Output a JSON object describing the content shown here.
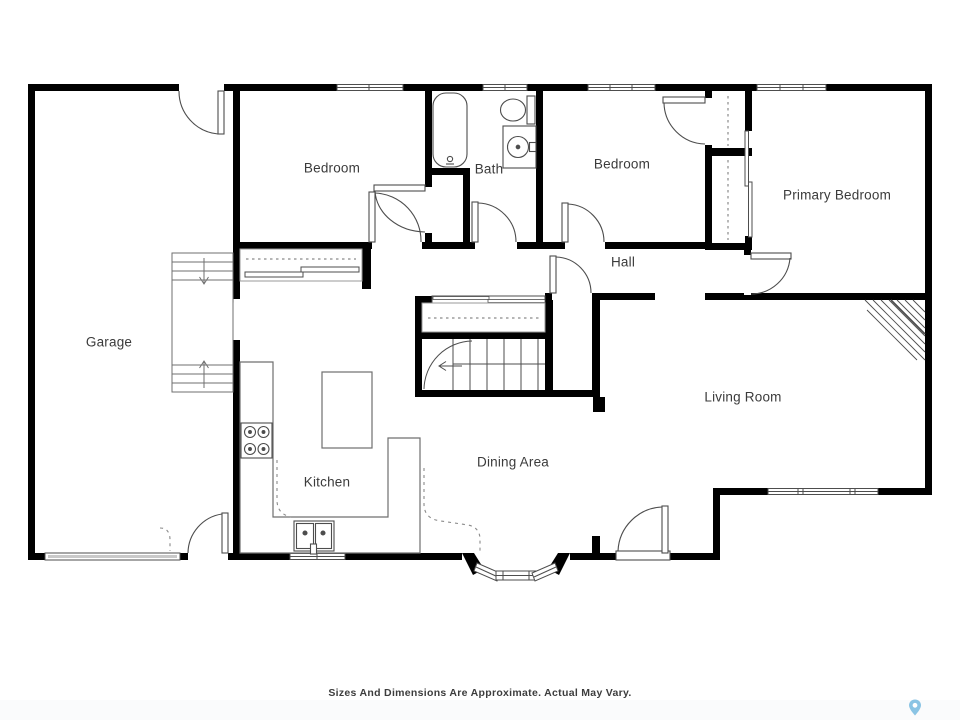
{
  "plan": {
    "rooms": [
      {
        "id": "garage",
        "label": "Garage"
      },
      {
        "id": "bedroom-1",
        "label": "Bedroom"
      },
      {
        "id": "bath",
        "label": "Bath"
      },
      {
        "id": "bedroom-2",
        "label": "Bedroom"
      },
      {
        "id": "primary-bedroom",
        "label": "Primary Bedroom"
      },
      {
        "id": "hall",
        "label": "Hall"
      },
      {
        "id": "kitchen",
        "label": "Kitchen"
      },
      {
        "id": "dining-area",
        "label": "Dining Area"
      },
      {
        "id": "living-room",
        "label": "Living Room"
      }
    ],
    "footer": {
      "disclaimer": "Sizes And Dimensions Are Approximate. Actual May Vary."
    },
    "icons": {
      "watermark": "location-pin-icon"
    },
    "colors": {
      "wall": "#000000",
      "fixture_line": "#4d4d4d",
      "label_text": "#3b3b3b",
      "garage_door": "#c9c9c9",
      "pin_blue": "#8ac4e4",
      "background": "#ffffff"
    }
  }
}
